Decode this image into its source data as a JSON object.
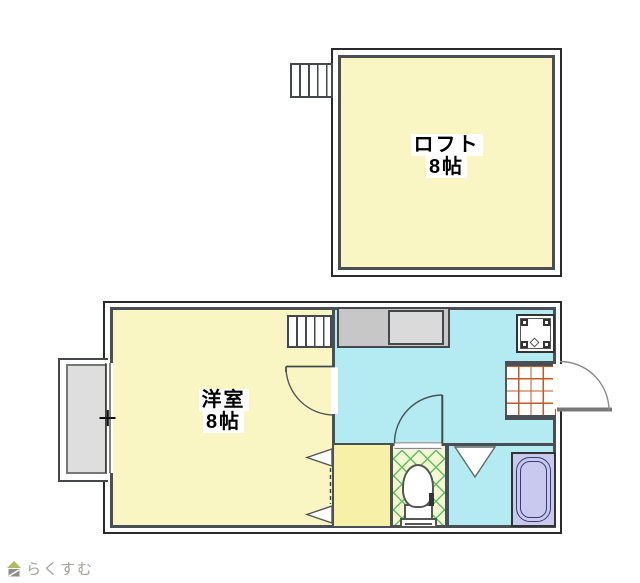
{
  "meta": {
    "type": "floor-plan",
    "floors": 2
  },
  "loft": {
    "label": "ロフト",
    "size": "8帖"
  },
  "main": {
    "western_room": {
      "label": "洋室",
      "size": "8帖"
    },
    "fixtures": [
      "stairs-loft",
      "stairs-room",
      "kitchen-counter",
      "sink",
      "washing-machine-pan",
      "entrance-tile",
      "entrance-door",
      "toilet",
      "bathtub",
      "balcony",
      "window",
      "closet-folding-door",
      "bathroom-folding-door",
      "room-door",
      "toilet-door"
    ]
  },
  "logo": {
    "text": "らくすむ",
    "icon": "house-icon"
  },
  "colors": {
    "room_yellow": "#faf6c4",
    "closet_yellow": "#f7f0a8",
    "kitchen_cyan": "#b4ebf2",
    "toilet_bg": "#f3f7d2",
    "toilet_lattice": "#5fc05f",
    "bath_purple": "#c9c9f0",
    "wall_dark": "#4a4f55",
    "outline": "#2a2a2a",
    "counter_gray": "#c7c7c7",
    "balcony_gray": "#dedede",
    "tile_line": "#c05a28"
  }
}
